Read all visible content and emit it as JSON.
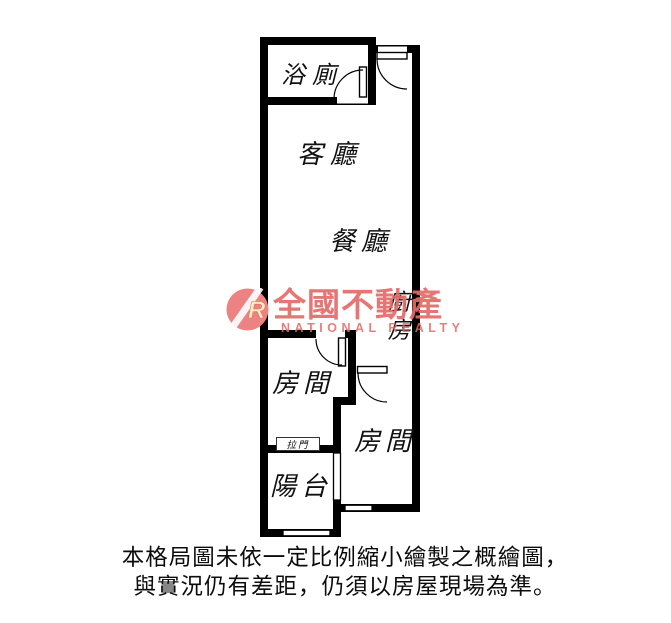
{
  "floor_plan": {
    "rooms": {
      "bathroom": "浴廁",
      "living_room": "客廳",
      "dining_room": "餐廳",
      "kitchen": "廚房",
      "bedroom_1": "房間",
      "bedroom_2": "房間",
      "balcony": "陽台",
      "sliding_door": "拉門"
    },
    "colors": {
      "wall": "#000000",
      "background": "#ffffff"
    }
  },
  "watermark": {
    "logo_letter": "R",
    "brand_zh": "全國不動產",
    "brand_en": "NATIONAL REALTY",
    "color": "#e26a68"
  },
  "disclaimer": {
    "line1": "本格局圖未依一定比例縮小繪製之概繪圖，",
    "line2": "與實況仍有差距，仍須以房屋現場為準。"
  }
}
